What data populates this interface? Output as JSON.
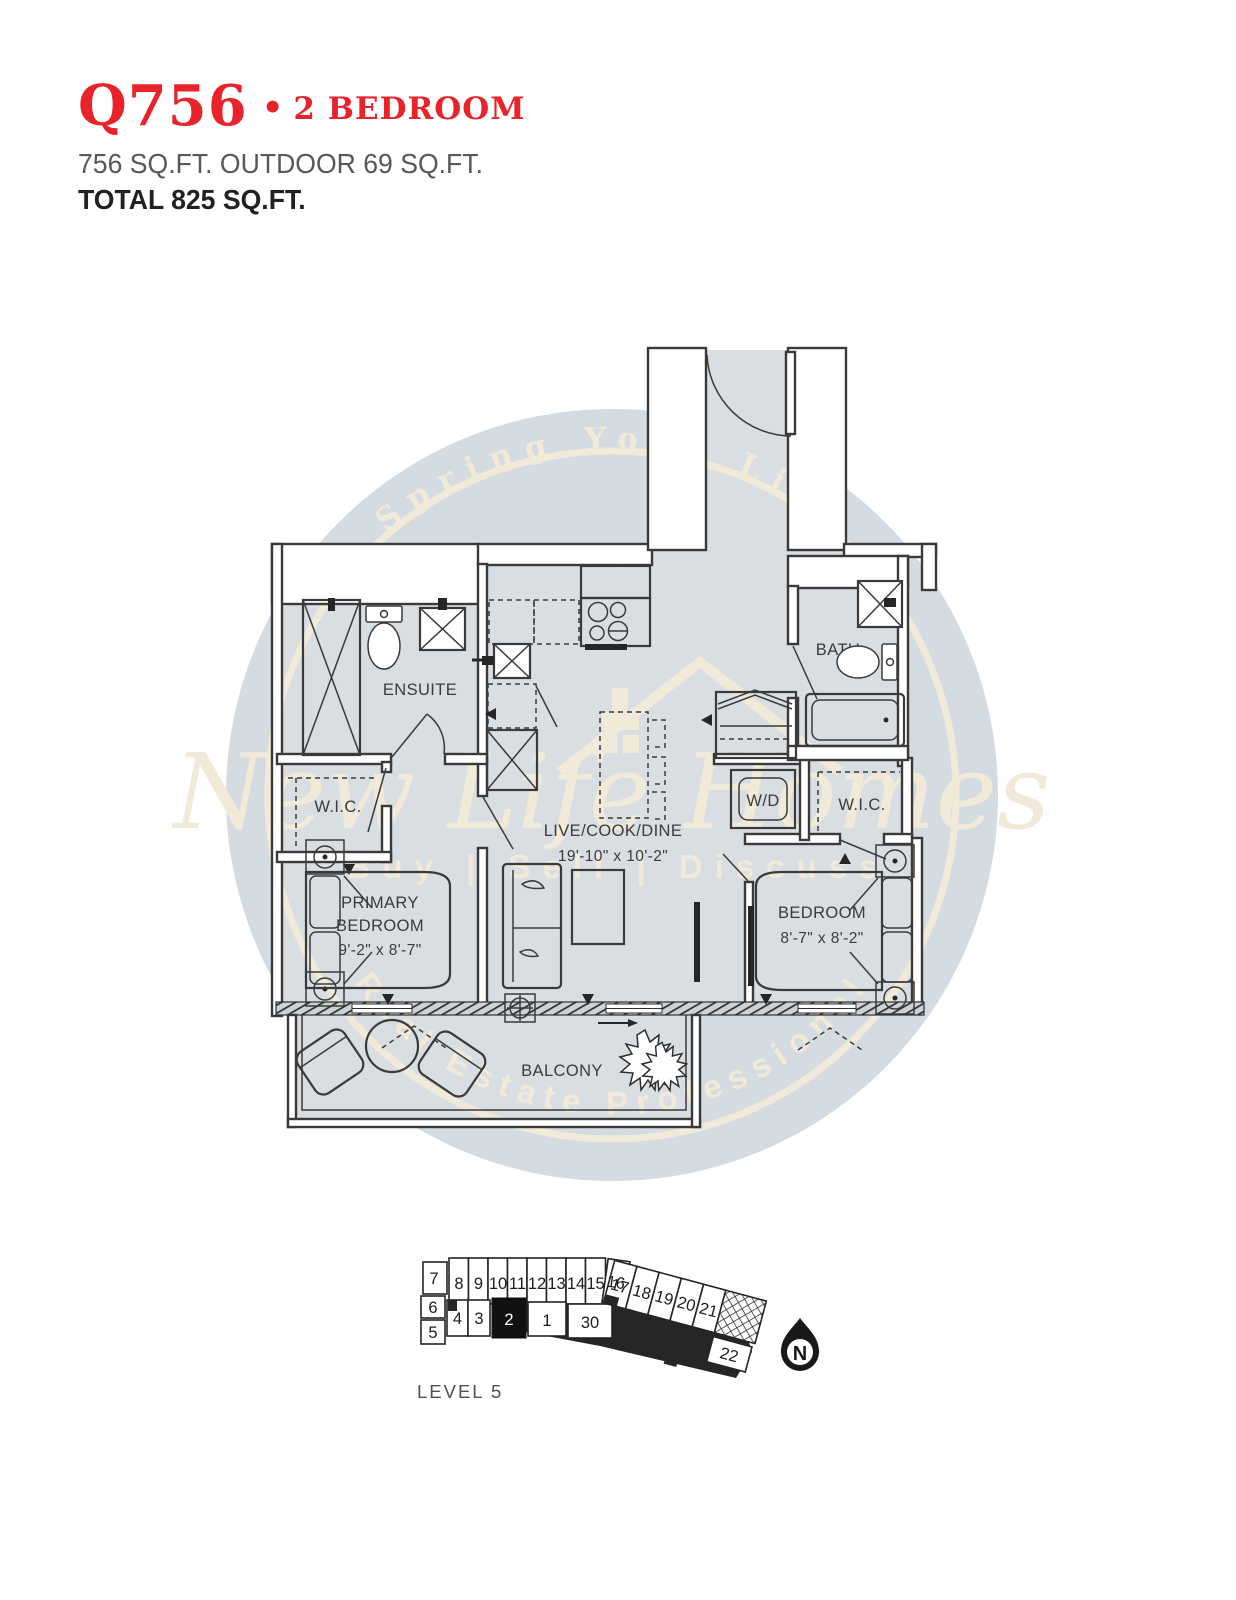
{
  "header": {
    "unit_code": "Q756",
    "separator": "•",
    "unit_type": "2 BEDROOM",
    "area_line": "756 SQ.FT. OUTDOOR 69 SQ.FT.",
    "total_line": "TOTAL 825 SQ.FT."
  },
  "watermark": {
    "arc_top": "Spring Your Life",
    "with_word": "with",
    "script_name": "New Life Homes",
    "tagline": "Buy | Sell | Discuss",
    "arc_bottom": "Real Estate Professional"
  },
  "colors": {
    "accent_red": "#e8232a",
    "floor_fill": "#d9dee3",
    "watermark_circle": "#d4dbe1",
    "watermark_cream": "#f2ead9",
    "line_dark": "#3a3a3a"
  },
  "floorplan": {
    "ensuite_label": "ENSUITE",
    "wic_left_label": "W.I.C.",
    "primary_bedroom_line1": "PRIMARY",
    "primary_bedroom_line2": "BEDROOM",
    "primary_bedroom_dims": "9'-2\" x 8'-7\"",
    "live_label": "LIVE/COOK/DINE",
    "live_dims": "19'-10\" x 10'-2\"",
    "bath_label": "BATH",
    "wd_label": "W/D",
    "wic_right_label": "W.I.C.",
    "bedroom_label": "BEDROOM",
    "bedroom_dims": "8'-7\" x 8'-2\"",
    "balcony_label": "BALCONY"
  },
  "keyplan": {
    "level_label": "LEVEL 5",
    "north_label": "N",
    "highlighted_unit": "2",
    "units": {
      "u1": "1",
      "u2": "2",
      "u3": "3",
      "u4": "4",
      "u5": "5",
      "u6": "6",
      "u7": "7",
      "u8": "8",
      "u9": "9",
      "u10": "10",
      "u11": "11",
      "u12": "12",
      "u13": "13",
      "u14": "14",
      "u15": "15",
      "u16": "16",
      "u17": "17",
      "u18": "18",
      "u19": "19",
      "u20": "20",
      "u21": "21",
      "u22": "22",
      "u30": "30"
    }
  }
}
